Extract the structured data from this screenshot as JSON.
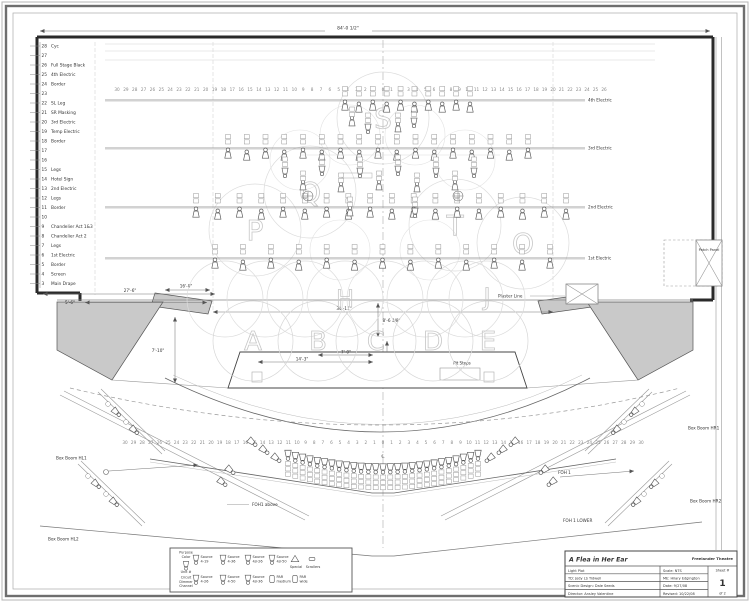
{
  "drawing": {
    "overall_dim": "84'-0 1/2\"",
    "dims": {
      "sr_offstage": "27'-6\"",
      "sr_inner": "5'-6\"",
      "apron_left": "16'-0\"",
      "apron_depth": "7'-10\"",
      "proscenium": "34'-11\"",
      "plaster_to_apron": "8'-6 3/8\"",
      "pit_width": "14'-3\"",
      "pit_half": "7'-0\""
    },
    "labels": {
      "plaster_line": "Plaster Line",
      "patch_panel": "Patch Panel",
      "pit_steps": "Pit Steps",
      "foh1": "FOH 1",
      "foh1_above": "FOH1 above",
      "foh1_lower": "FOH 1 LOWER",
      "centerline": "℄"
    },
    "line_sets": [
      {
        "num": "28",
        "label": "Cyc"
      },
      {
        "num": "27",
        "label": ""
      },
      {
        "num": "26",
        "label": "Full Stage Black"
      },
      {
        "num": "25",
        "label": "4th Electric"
      },
      {
        "num": "24",
        "label": "Border"
      },
      {
        "num": "23",
        "label": ""
      },
      {
        "num": "22",
        "label": "SL Leg"
      },
      {
        "num": "21",
        "label": "SR Masking"
      },
      {
        "num": "20",
        "label": "3rd Electric"
      },
      {
        "num": "19",
        "label": "Temp Electric"
      },
      {
        "num": "18",
        "label": "Border"
      },
      {
        "num": "17",
        "label": ""
      },
      {
        "num": "16",
        "label": ""
      },
      {
        "num": "15",
        "label": "Legs"
      },
      {
        "num": "14",
        "label": "Hotel Sign"
      },
      {
        "num": "13",
        "label": "2nd Electric"
      },
      {
        "num": "12",
        "label": "Legs"
      },
      {
        "num": "11",
        "label": "Border"
      },
      {
        "num": "10",
        "label": ""
      },
      {
        "num": "9",
        "label": "Chandelier Act 1&3"
      },
      {
        "num": "8",
        "label": "Chandelier Act 2"
      },
      {
        "num": "7",
        "label": "Legs"
      },
      {
        "num": "6",
        "label": "1st Electric"
      },
      {
        "num": "5",
        "label": "Border"
      },
      {
        "num": "4",
        "label": "Screen"
      },
      {
        "num": "3",
        "label": "Main Drape"
      }
    ],
    "electrics": [
      {
        "label": "4th Electric",
        "units": 10
      },
      {
        "label": "3rd Electric",
        "units": 17
      },
      {
        "label": "2nd Electric",
        "units": 18
      },
      {
        "label": "1st Electric",
        "units": 13
      }
    ],
    "booms": [
      {
        "label": "Box Boom HL1",
        "units": 2
      },
      {
        "label": "Box Boom HL2",
        "units": 2
      },
      {
        "label": "Box Boom HR1",
        "units": 2
      },
      {
        "label": "Box Boom HR2",
        "units": 2
      }
    ],
    "foh": {
      "arc_units": 27,
      "side_units_per_side": 5
    },
    "areas": {
      "apron": [
        "A",
        "B",
        "C",
        "D",
        "E"
      ],
      "plaster": [
        "H",
        "J"
      ],
      "mid": [
        "P",
        "Q",
        "S",
        "T",
        "O"
      ]
    },
    "stage_scale": [
      30,
      29,
      28,
      27,
      26,
      25,
      24,
      23,
      22,
      21,
      20,
      19,
      18,
      17,
      16,
      15,
      14,
      13,
      12,
      11,
      10,
      9,
      8,
      7,
      6,
      5,
      4,
      3,
      2,
      1,
      0,
      1,
      2,
      3,
      4,
      5,
      6,
      7,
      8,
      9,
      10,
      11,
      12,
      13,
      14,
      15,
      16,
      17,
      18,
      19,
      20,
      21,
      22,
      23,
      24,
      25,
      26
    ],
    "foh_scale": [
      30,
      29,
      28,
      27,
      26,
      25,
      24,
      23,
      22,
      21,
      20,
      19,
      18,
      17,
      16,
      15,
      14,
      13,
      12,
      11,
      10,
      9,
      8,
      7,
      6,
      5,
      4,
      3,
      2,
      1,
      0,
      1,
      2,
      3,
      4,
      5,
      6,
      7,
      8,
      9,
      10,
      11,
      12,
      13,
      14,
      15,
      16,
      17,
      18,
      19,
      20,
      21,
      22,
      23,
      24,
      25,
      26,
      27,
      28,
      29,
      30
    ]
  },
  "legend": {
    "key": {
      "top": "Purpose Color",
      "mid": "Unit #",
      "bottom": "Circuit Dimmer Channel"
    },
    "row1": [
      {
        "l1": "Source",
        "l2": "4-19",
        "type": "source"
      },
      {
        "l1": "Source",
        "l2": "4-36",
        "type": "source"
      },
      {
        "l1": "Source",
        "l2": "4jr-26",
        "type": "source"
      },
      {
        "l1": "Source",
        "l2": "4jr-50",
        "type": "source"
      },
      {
        "l1": "Special",
        "l2": "",
        "type": "special"
      },
      {
        "l1": "Scrollers",
        "l2": "",
        "type": "scroller"
      }
    ],
    "row2": [
      {
        "l1": "Source",
        "l2": "4-26",
        "type": "source"
      },
      {
        "l1": "Source",
        "l2": "4-50",
        "type": "source"
      },
      {
        "l1": "Source",
        "l2": "4jr-36",
        "type": "source"
      },
      {
        "l1": "PAR",
        "l2": "medium",
        "type": "par"
      },
      {
        "l1": "PAR",
        "l2": "wide",
        "type": "par"
      }
    ],
    "box_boom_labels": [
      "Box Boom HL1",
      "Box Boom HL2",
      "Box Boom HR1",
      "Box Boom HR2"
    ]
  },
  "title_block": {
    "title": "A Flea in Her Ear",
    "theatre": "Freelander Theatre",
    "doc_type": "Light Plot",
    "scale": "Scale: NTS",
    "td": "TD: Jody LS Tidwell",
    "me": "ME: Hilary Edgington",
    "scenic": "Scenic Design: Dale Seeds",
    "date": "Date: 9/27/08",
    "director": "Director: Ansley Valentine",
    "revised": "Revised: 10/22/08",
    "sheet_label": "Sheet #",
    "sheet_number": "1",
    "sheet_of": "of 2"
  }
}
